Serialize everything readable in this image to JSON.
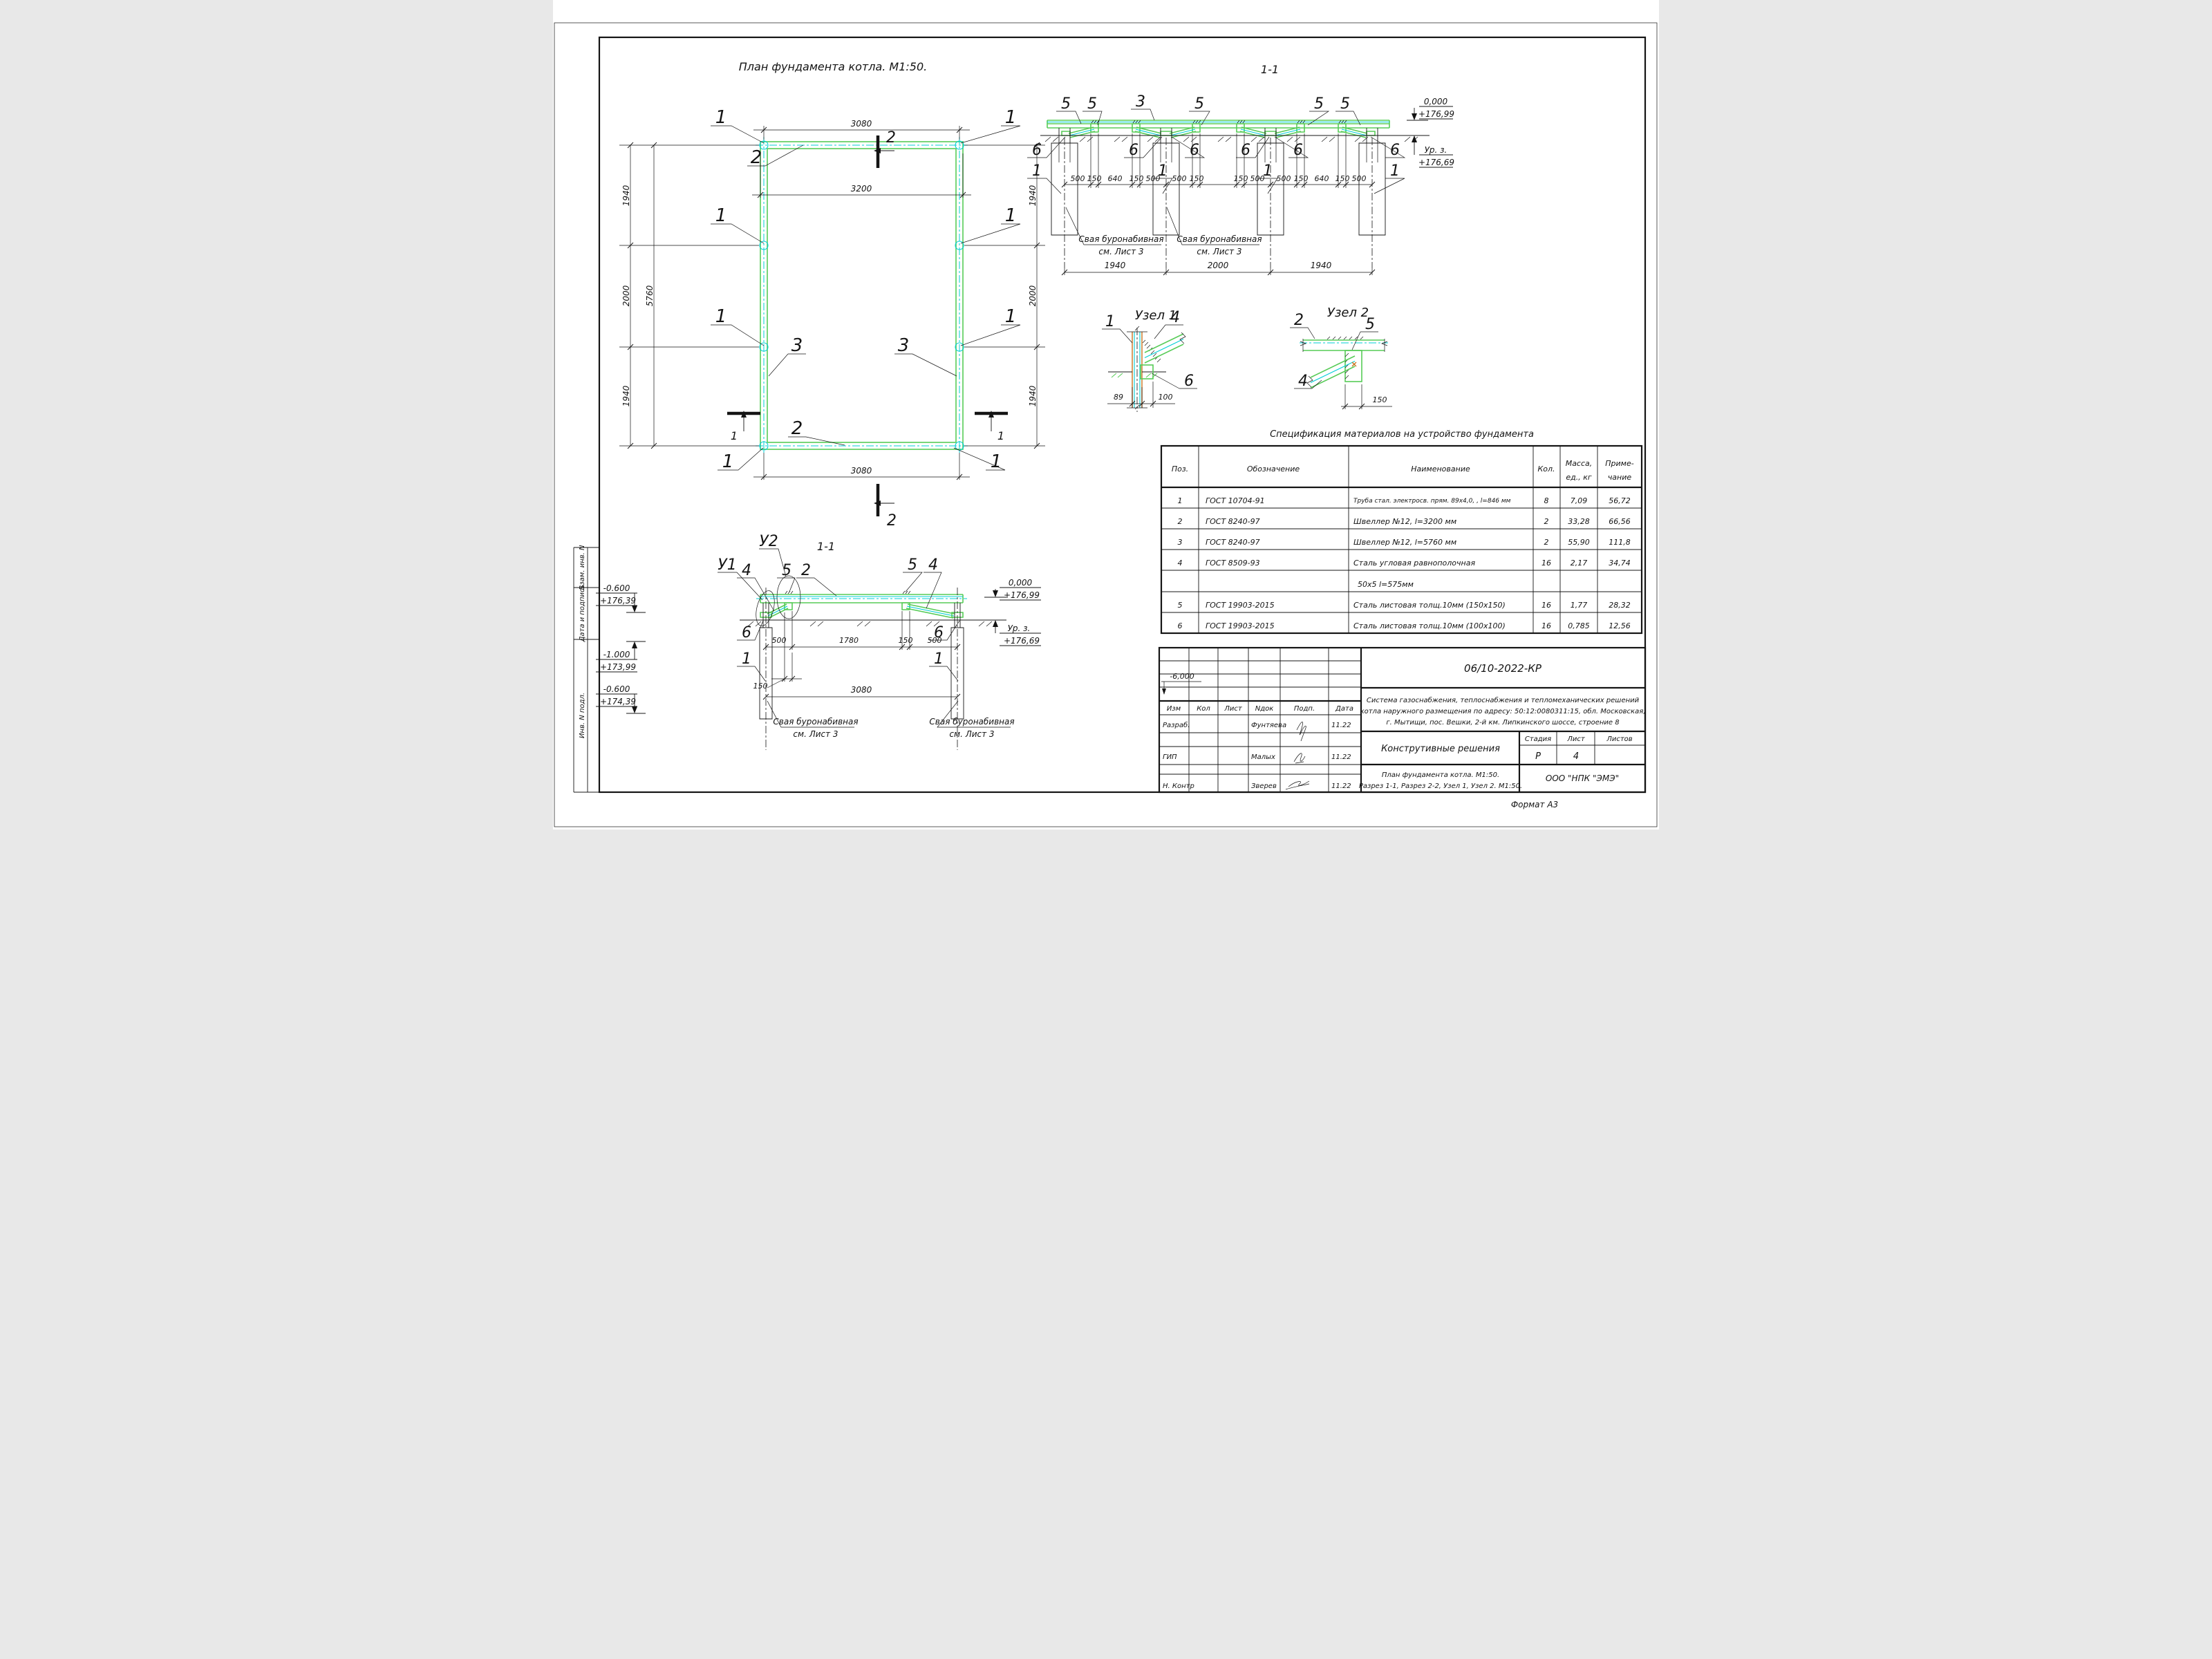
{
  "plan": {
    "title": "План фундамента котла. М1:50.",
    "dim_top": "3080",
    "dim_inner": "3200",
    "dim_bottom": "3080",
    "dim_side": [
      "1940",
      "2000",
      "1940"
    ],
    "dim_total": "5760",
    "pos_pile": "1",
    "pos_ch32": "2",
    "pos_ch57": "3",
    "mark2": "2",
    "mark1": "1"
  },
  "sec1": {
    "title": "1-1",
    "b5": "5",
    "b3": "3",
    "b6": "6",
    "b1": "1",
    "d500": "500",
    "d150": "150",
    "d640": "640",
    "row2": [
      "1940",
      "2000",
      "1940"
    ],
    "elev0": "0,000",
    "elev0v": "+176,99",
    "urz": "Ур. з.",
    "urzv": "+176,69"
  },
  "note": {
    "l1": "Свая буронабивная",
    "l2": "см. Лист 3"
  },
  "node1": {
    "title": "Узел 1",
    "p1": "1",
    "p4": "4",
    "p6": "6",
    "d89": "89",
    "d100": "100"
  },
  "node2": {
    "title": "Узел 2",
    "p2": "2",
    "p5": "5",
    "p4": "4",
    "d150": "150"
  },
  "sec2": {
    "title": "1-1",
    "u1": "У1",
    "u2": "У2",
    "p4": "4",
    "p5": "5",
    "p2": "2",
    "p6": "6",
    "p1": "1",
    "d500": "500",
    "d1780": "1780",
    "d150": "150",
    "d3080": "3080",
    "e06": "-0.600",
    "e06v": "+176,39",
    "e10": "-1.000",
    "e10v": "+173,99",
    "e06b": "-0.600",
    "e06bv": "+174,39",
    "e0": "0,000",
    "e0v": "+176,99",
    "urz": "Ур. з.",
    "urzv": "+176,69"
  },
  "spec": {
    "title": "Спецификация материалов на устройство фундамента",
    "h": {
      "pos": "Поз.",
      "sign": "Обозначение",
      "name": "Наименование",
      "qty": "Кол.",
      "mass1": "Масса,",
      "mass2": "ед., кг",
      "note1": "Приме-",
      "note2": "чание"
    },
    "rows": [
      {
        "pos": "1",
        "doc": "ГОСТ 10704-91",
        "name": "Труба стал. электросв. прям. 89х4,0, , l=846 мм",
        "qty": "8",
        "mass": "7,09",
        "note": "56,72"
      },
      {
        "pos": "2",
        "doc": "ГОСТ 8240-97",
        "name": "Швеллер №12, l=3200 мм",
        "qty": "2",
        "mass": "33,28",
        "note": "66,56"
      },
      {
        "pos": "3",
        "doc": "ГОСТ 8240-97",
        "name": "Швеллер №12, l=5760 мм",
        "qty": "2",
        "mass": "55,90",
        "note": "111,8"
      },
      {
        "pos": "4",
        "doc": "ГОСТ 8509-93",
        "name": "Сталь угловая равнополочная",
        "qty": "16",
        "mass": "2,17",
        "note": "34,74"
      },
      {
        "pos": "",
        "doc": "",
        "name": "50х5 l=575мм",
        "qty": "",
        "mass": "",
        "note": ""
      },
      {
        "pos": "5",
        "doc": "ГОСТ 19903-2015",
        "name": "Сталь листовая толщ.10мм (150х150)",
        "qty": "16",
        "mass": "1,77",
        "note": "28,32"
      },
      {
        "pos": "6",
        "doc": "ГОСТ 19903-2015",
        "name": "Сталь листовая толщ.10мм (100х100)",
        "qty": "16",
        "mass": "0,785",
        "note": "12,56"
      }
    ]
  },
  "tb": {
    "doc": "06/10-2022-КР",
    "desc1": "Система газоснабжения, теплоснабжения и тепломеханических решений",
    "desc2": "котла наружного размещения по адресу: 50:12:0080311:15, обл. Московская,",
    "desc3": "г. Мытищи, пос. Вешки, 2-й км. Липкинского шоссе, строение 8",
    "name": "Конструтивные решения",
    "sheet1": "План фундамента котла. М1:50.",
    "sheet2": "Разрез 1-1, Разрез 2-2, Узел 1, Узел 2. М1:50.",
    "c_izm": "Изм",
    "c_kol": "Кол",
    "c_list": "Лист",
    "c_ndok": "Nдок",
    "c_podp": "Подп.",
    "c_data": "Дата",
    "r1l": "Разраб.",
    "r1n": "Фунтяева",
    "r1d": "11.22",
    "r2l": "ГИП",
    "r2n": "Малых",
    "r2d": "11.22",
    "r3l": "Н. Контр",
    "r3n": "Зверев",
    "r3d": "11.22",
    "stage": "Стадия",
    "list": "Лист",
    "listov": "Листов",
    "stage_v": "Р",
    "list_v": "4",
    "company": "ООО \"НПК \"ЭМЭ\"",
    "artifact": "-6,000"
  },
  "strip": {
    "a": "Взам. инв. N",
    "b": "Дата и подпись",
    "c": "Инв. N подл."
  },
  "sheet": {
    "format": "Формат А3"
  }
}
